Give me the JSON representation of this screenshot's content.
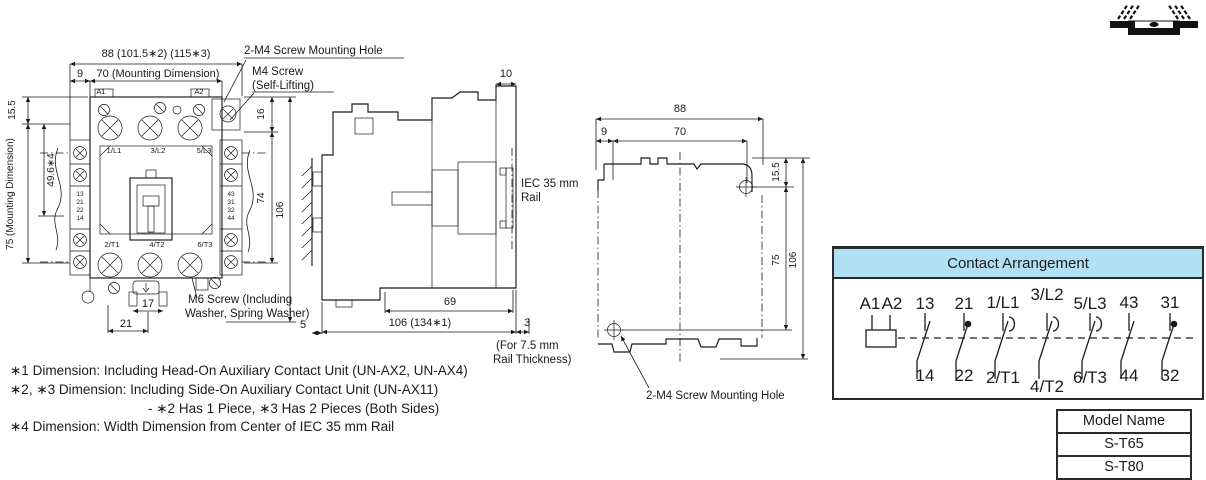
{
  "palette": {
    "line": "#1a1a1a",
    "header_bg": "#b2dff4",
    "border_dark": "#2b2b2b"
  },
  "front_view": {
    "dim_total_width": "88 (101.5∗2) (115∗3)",
    "dim_side_offset": "9",
    "dim_mounting_width": "70 (Mounting Dimension)",
    "ann_m4_hole": "2-M4 Screw Mounting Hole",
    "ann_m4_screw_line1": "M4 Screw",
    "ann_m4_screw_line2": "(Self-Lifting)",
    "dim_top_height": "16",
    "dim_top_offset": "15.5",
    "dim_rail_center": "49.6∗4",
    "dim_mounting_height": "75 (Mounting Dimension)",
    "dim_body_height": "74",
    "dim_total_height": "106",
    "terminals": {
      "a1": "A1",
      "a2": "A2",
      "l1": "1/L1",
      "l2": "3/L2",
      "l3": "5/L3",
      "t1": "2/T1",
      "t2": "4/T2",
      "t3": "6/T3"
    },
    "aux_left": [
      "13",
      "21",
      "22",
      "14"
    ],
    "aux_right": [
      "43",
      "31",
      "32",
      "44"
    ],
    "dim_foot_inner": "17",
    "dim_foot_outer": "21",
    "ann_m6_line1": "M6 Screw (Including",
    "ann_m6_line2": "Washer, Spring Washer)",
    "dim_gap": "5"
  },
  "side_view": {
    "dim_top_step": "10",
    "ann_rail_line1": "IEC 35 mm",
    "ann_rail_line2": "Rail",
    "dim_inner_depth": "69",
    "dim_total_depth": "106 (134∗1)",
    "dim_rail_gap": "3",
    "ann_rail_thickness_line1": "(For 7.5 mm",
    "ann_rail_thickness_line2": "Rail Thickness)"
  },
  "rear_view": {
    "dim_total_width": "88",
    "dim_side_offset": "9",
    "dim_mounting_width": "70",
    "dim_top_offset": "15.5",
    "dim_mounting_height": "75",
    "dim_total_height": "106",
    "ann_m4_hole": "2-M4 Screw Mounting Hole"
  },
  "contact_arrangement": {
    "title": "Contact Arrangement",
    "top_labels": [
      "A1",
      "A2",
      "13",
      "21",
      "1/L1",
      "3/L2",
      "5/L3",
      "43",
      "31"
    ],
    "bottom_labels": [
      "14",
      "22",
      "2/T1",
      "4/T2",
      "6/T3",
      "44",
      "32"
    ]
  },
  "model_table": {
    "header": "Model Name",
    "rows": [
      "S-T65",
      "S-T80"
    ]
  },
  "footnotes": [
    "∗1 Dimension: Including Head-On Auxiliary Contact Unit (UN-AX2, UN-AX4)",
    "∗2, ∗3 Dimension: Including Side-On Auxiliary Contact Unit (UN-AX11)",
    "- ∗2 Has 1 Piece, ∗3 Has 2 Pieces (Both Sides)",
    "∗4 Dimension: Width Dimension from Center of IEC 35 mm Rail"
  ]
}
